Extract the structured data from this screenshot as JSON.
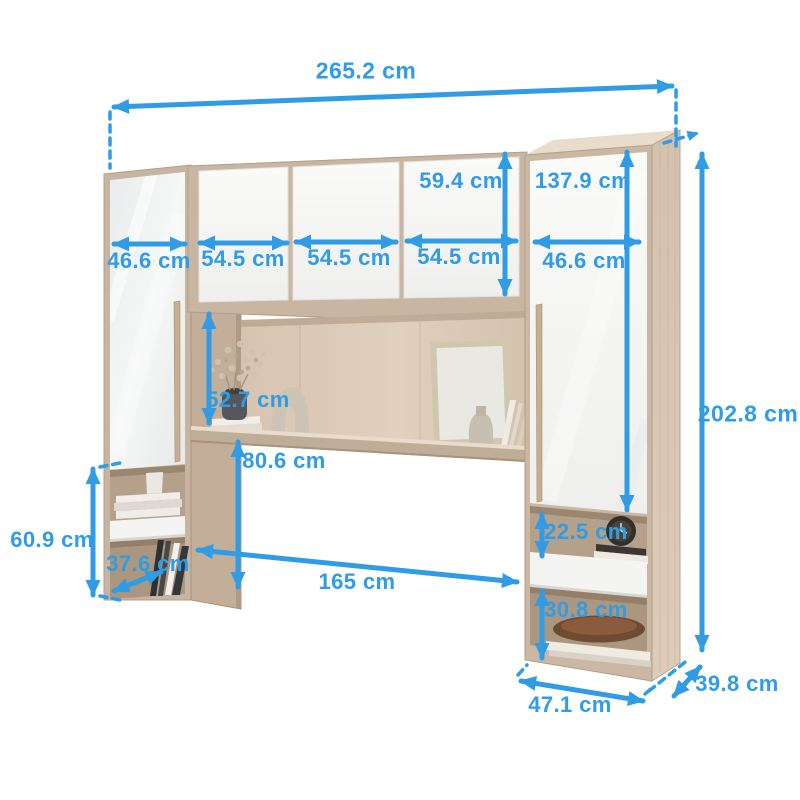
{
  "diagram": {
    "type": "furniture-dimension-diagram",
    "subject": "bridging wardrobe with mirrored side cabinets, overhead doors and open shelving",
    "unit": "cm",
    "colors": {
      "accent": "#2f9ce5",
      "wood": "#d0bda9",
      "wood_dark": "#b7a28c",
      "door_white": "#f7f7f5",
      "background": "#ffffff"
    },
    "labels": {
      "total_width": "265.2 cm",
      "top_door_height": "59.4 cm",
      "right_door_height": "137.9 cm",
      "left_door_width": "46.6 cm",
      "top_door1_width": "54.5 cm",
      "top_door2_width": "54.5 cm",
      "top_door3_width": "54.5 cm",
      "right_door_width": "46.6 cm",
      "total_height": "202.8 cm",
      "niche_height": "52.7 cm",
      "under_shelf_height": "80.6 cm",
      "left_unit_height": "60.9 cm",
      "left_unit_depth": "37.6 cm",
      "opening_width": "165 cm",
      "right_top_opening_height": "22.5 cm",
      "right_bottom_opening_height": "30.8 cm",
      "right_unit_width": "47.1 cm",
      "unit_depth": "39.8 cm"
    }
  }
}
